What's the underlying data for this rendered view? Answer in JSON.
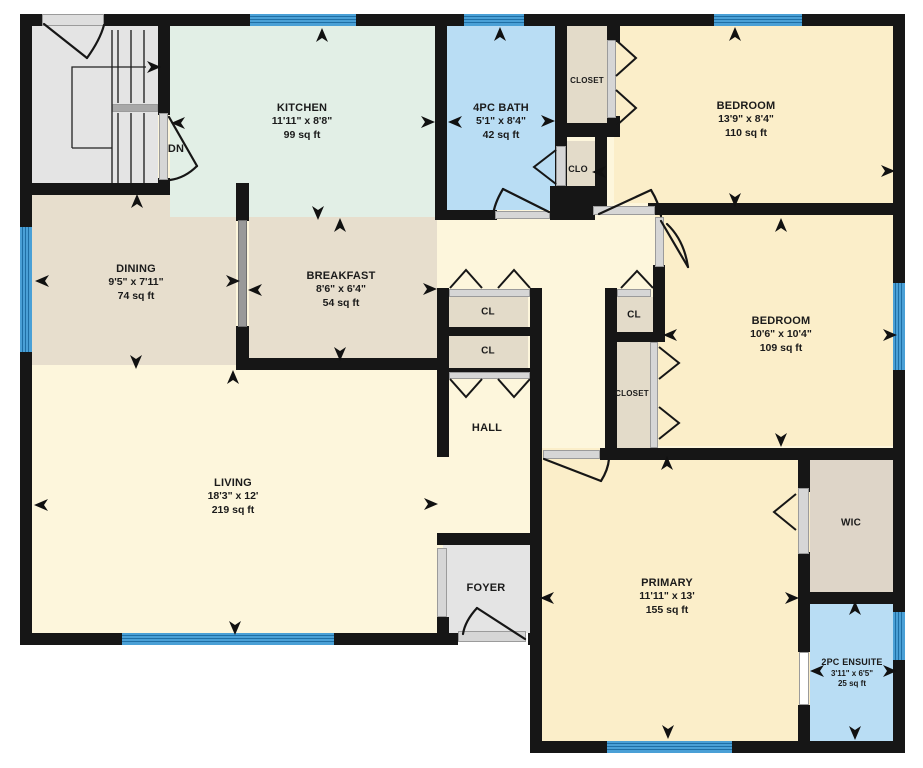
{
  "plan": {
    "type": "residential floor plan",
    "stair_direction_label": "DN"
  },
  "rooms": {
    "kitchen": {
      "name": "KITCHEN",
      "dims": "11'11\" x 8'8\"",
      "area": "99 sq ft"
    },
    "bath": {
      "name": "4PC BATH",
      "dims": "5'1\" x 8'4\"",
      "area": "42 sq ft"
    },
    "closet_top": {
      "name": "CLOSET"
    },
    "clo": {
      "name": "CLO"
    },
    "bedroom1": {
      "name": "BEDROOM",
      "dims": "13'9\" x 8'4\"",
      "area": "110 sq ft"
    },
    "dining": {
      "name": "DINING",
      "dims": "9'5\" x 7'11\"",
      "area": "74 sq ft"
    },
    "breakfast": {
      "name": "BREAKFAST",
      "dims": "8'6\" x 6'4\"",
      "area": "54 sq ft"
    },
    "cl_hall_1": {
      "name": "CL"
    },
    "cl_hall_2": {
      "name": "CL"
    },
    "cl_bed2": {
      "name": "CL"
    },
    "closet_bed2": {
      "name": "CLOSET"
    },
    "bedroom2": {
      "name": "BEDROOM",
      "dims": "10'6\" x 10'4\"",
      "area": "109 sq ft"
    },
    "hall": {
      "name": "HALL"
    },
    "living": {
      "name": "LIVING",
      "dims": "18'3\" x 12'",
      "area": "219 sq ft"
    },
    "foyer": {
      "name": "FOYER"
    },
    "primary": {
      "name": "PRIMARY",
      "dims": "11'11\" x 13'",
      "area": "155 sq ft"
    },
    "wic": {
      "name": "WIC"
    },
    "ensuite": {
      "name": "2PC ENSUITE",
      "dims": "3'11\" x 6'5\"",
      "area": "25 sq ft"
    }
  },
  "colors": {
    "wall": "#161616",
    "window_blue": "#4aa0d6",
    "kitchen_green": "#e2efe6",
    "bath_blue": "#b9ddf4",
    "bedroom_cream": "#fbeec9",
    "hall_pale": "#fdf6dc",
    "dining_tan": "#e7decd",
    "closet_beige": "#e3dbc9",
    "wic_taupe": "#ded5c8",
    "stair_gray": "#e4e4e4"
  }
}
